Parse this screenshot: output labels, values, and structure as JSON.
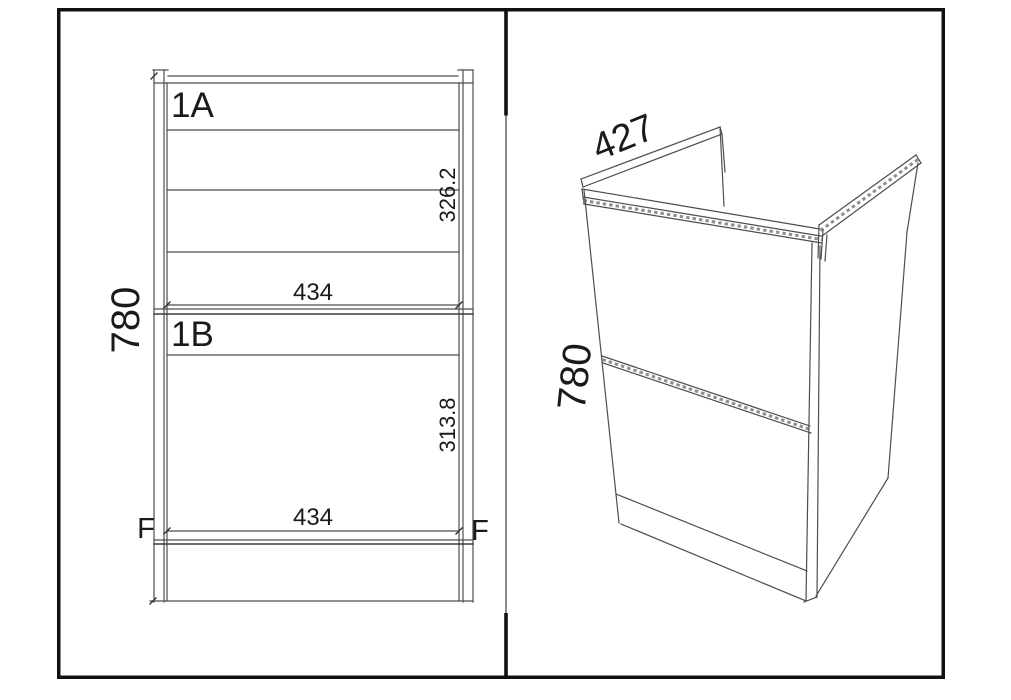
{
  "colors": {
    "background": "#ffffff",
    "frame": "#111111",
    "line": "#4d4d4d",
    "text": "#1a1a1a"
  },
  "front_view": {
    "height_label": "780",
    "drawer_a": {
      "id": "1A",
      "front_height": "326.2",
      "width": "434"
    },
    "drawer_b": {
      "id": "1B",
      "front_height": "313.8",
      "width": "434"
    },
    "fixing_marks": {
      "left": "F",
      "right": "F"
    }
  },
  "iso_view": {
    "depth_label": "427",
    "height_label": "780"
  }
}
